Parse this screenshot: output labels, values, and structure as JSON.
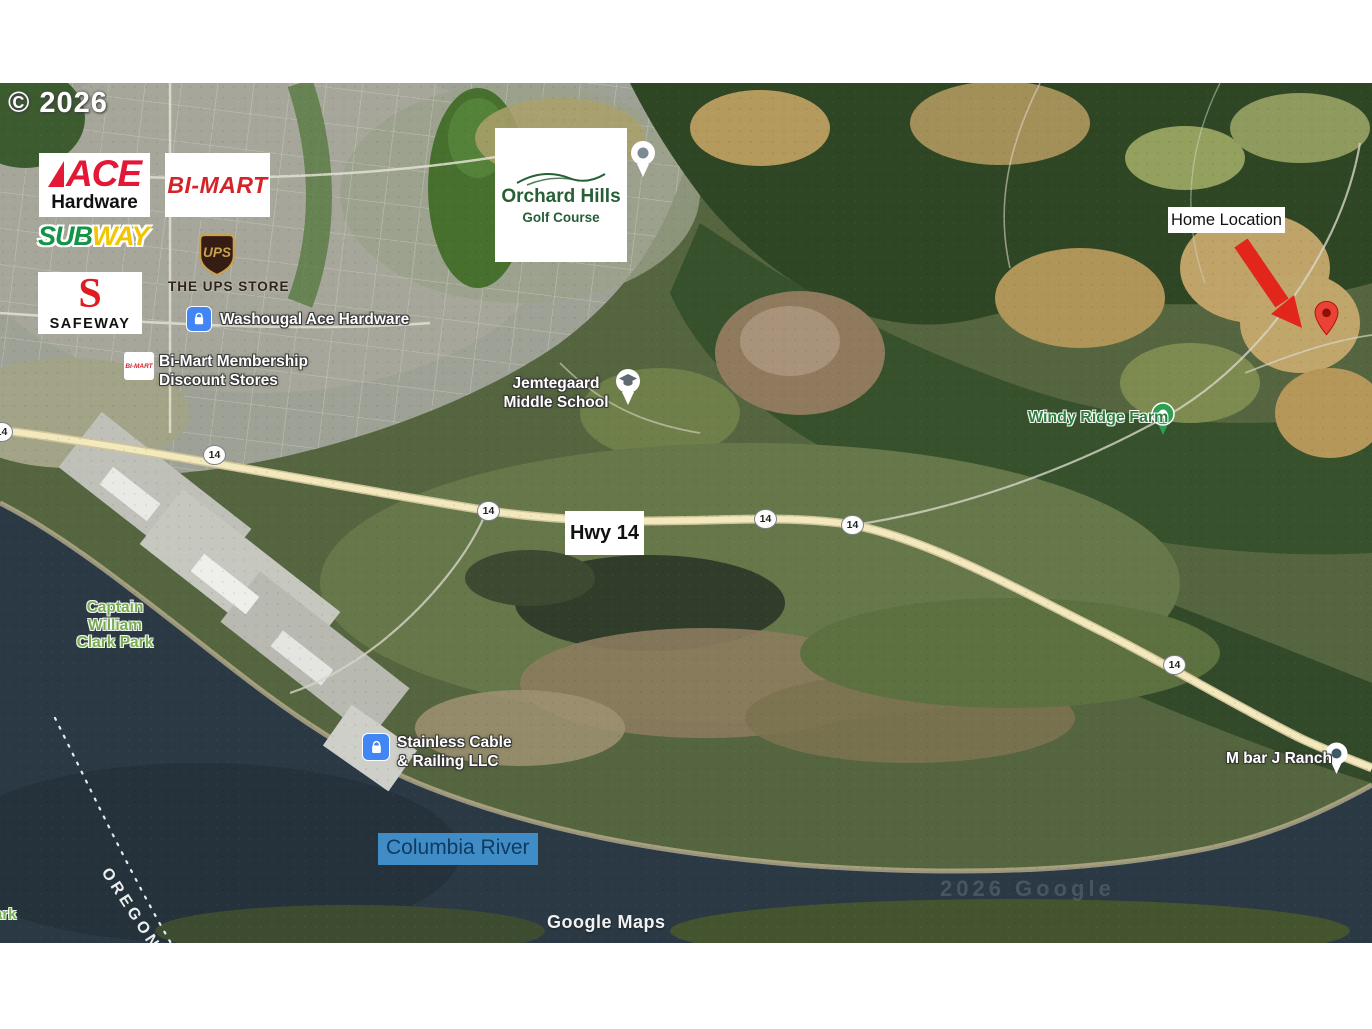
{
  "watermarks": {
    "copyright": "© 2026",
    "google_maps": "Google Maps",
    "faint_tiles": "2026 Google",
    "oregon_boundary": "OREGON",
    "partial_park": "ark"
  },
  "logos": {
    "ace_name": "ACE",
    "ace_sub": "Hardware",
    "bimart": "BI-MART",
    "bimart_mini": "BI-MART",
    "subway_sub": "SUB",
    "subway_way": "WAY",
    "ups": "UPS",
    "ups_store": "THE UPS STORE",
    "safeway_mark": "S",
    "safeway": "SAFEWAY",
    "orchard_name": "Orchard Hills",
    "orchard_sub": "Golf Course"
  },
  "map_labels": {
    "washougal_ace": "Washougal Ace Hardware",
    "bimart_membership_1": "Bi-Mart Membership",
    "bimart_membership_2": "Discount Stores",
    "jemtegaard_1": "Jemtegaard",
    "jemtegaard_2": "Middle School",
    "windy_ridge": "Windy Ridge Farm",
    "captain_1": "Captain",
    "captain_2": "William",
    "captain_3": "Clark Park",
    "stainless_1": "Stainless Cable",
    "stainless_2": "& Railing LLC",
    "columbia_river": "Columbia River",
    "m_bar_j": "M bar J Ranch"
  },
  "annotations": {
    "home_location": "Home Location",
    "hwy14": "Hwy 14",
    "route_shield": "14"
  },
  "colors": {
    "home_arrow_red": "#e2261c",
    "home_pin_red": "#ea4335",
    "river_water": "#2b3944",
    "river_label_highlight": "#3f8cc7",
    "river_label_text": "#103a5e",
    "park_label_green": "#76ad4e",
    "farm_label_green": "#2f7d3f",
    "poi_icon_blue": "#4285f4",
    "ace_red": "#e31837",
    "bimart_red": "#d5232a",
    "subway_green": "#149247",
    "subway_yellow": "#f2c500",
    "ups_brown": "#351c15",
    "ups_gold": "#c9a24b",
    "safeway_red": "#e01b22",
    "orchard_green": "#275f37",
    "highway_yellow": "#f3e9bd"
  }
}
